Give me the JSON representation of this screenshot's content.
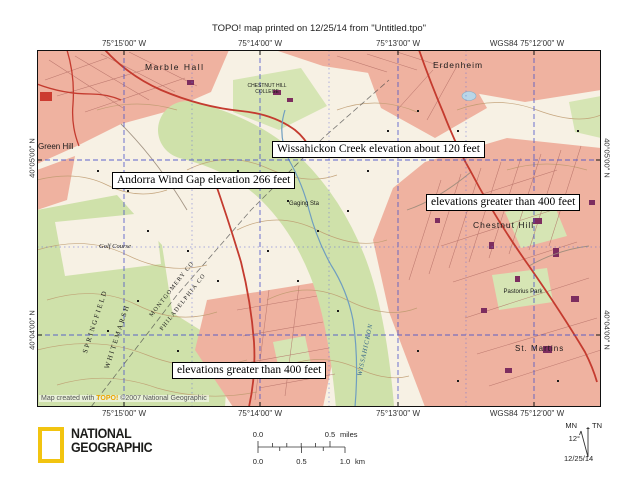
{
  "header": {
    "title": "TOPO! map printed on 12/25/14 from \"Untitled.tpo\""
  },
  "coordinates": {
    "top": [
      "75°15'00\" W",
      "75°14'00\" W",
      "75°13'00\" W",
      "WGS84 75°12'00\" W"
    ],
    "bottom": [
      "75°15'00\" W",
      "75°14'00\" W",
      "75°13'00\" W",
      "WGS84 75°12'00\" W"
    ],
    "left": [
      "40°05'00\" N",
      "40°04'00\" N"
    ],
    "right": [
      "40°05'00\" N",
      "40°04'00\" N"
    ]
  },
  "map": {
    "callouts": [
      {
        "text": "Wissahickon Creek elevation about 120 feet"
      },
      {
        "text": "Andorra Wind Gap elevation 266 feet"
      },
      {
        "text": "elevations greater than 400 feet"
      },
      {
        "text": "elevations greater than 400 feet"
      }
    ],
    "places": {
      "marble_hall": "Marble Hall",
      "erdenheim": "Erdenheim",
      "green_hill": "Green Hill",
      "chestnut_hill": "Chestnut Hill",
      "st_martins": "St. Martins",
      "pastorius_park": "Pastorius Park",
      "golf_course": "Golf Course",
      "gaging_sta": "Gaging Sta",
      "college_line1": "CHESTNUT HILL",
      "college_line2": "COLLEGE",
      "springfield": "SPRINGFIELD",
      "whitemarsh": "WHITEMARSH",
      "montgomery_co": "MONTGOMERY CO",
      "philadelphia_co": "PHILADELPHIA CO",
      "wissahickon": "WISSAHICKON"
    },
    "attribution": {
      "prefix": "Map created with ",
      "brand": "TOPO!",
      "suffix": " ©2007 National Geographic"
    }
  },
  "footer": {
    "logo": {
      "line1": "NATIONAL",
      "line2": "GEOGRAPHIC"
    },
    "scalebar": {
      "miles_label_0": "0.0",
      "miles_label_1": "0.5",
      "miles_unit": "miles",
      "km_label_0": "0.0",
      "km_label_1": "0.5",
      "km_label_2": "1.0",
      "km_unit": "km"
    },
    "compass": {
      "mn": "MN",
      "tn": "TN",
      "declination": "12°",
      "date": "12/25/14"
    }
  },
  "colors": {
    "urban_pink": "#efb2a0",
    "woodland_green": "#cfe1aa",
    "road_red": "#c43b2f",
    "grid_blue": "#4d55c9",
    "contour_brown": "#bd9a6e",
    "ng_yellow": "#f2c410"
  }
}
